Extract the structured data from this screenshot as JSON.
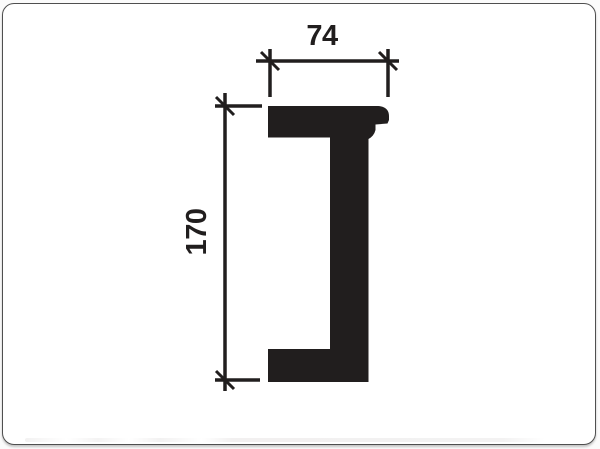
{
  "page": {
    "background": "#fbfbfb"
  },
  "card": {
    "background": "#ffffff",
    "border_color": "#4f4f4f"
  },
  "drawing": {
    "ink_color": "#211e1e",
    "subject": "molding-profile-cross-section",
    "dimensions": {
      "width": {
        "value": "74",
        "orientation": "horizontal",
        "position": "top"
      },
      "height": {
        "value": "170",
        "orientation": "vertical",
        "position": "left"
      }
    }
  }
}
